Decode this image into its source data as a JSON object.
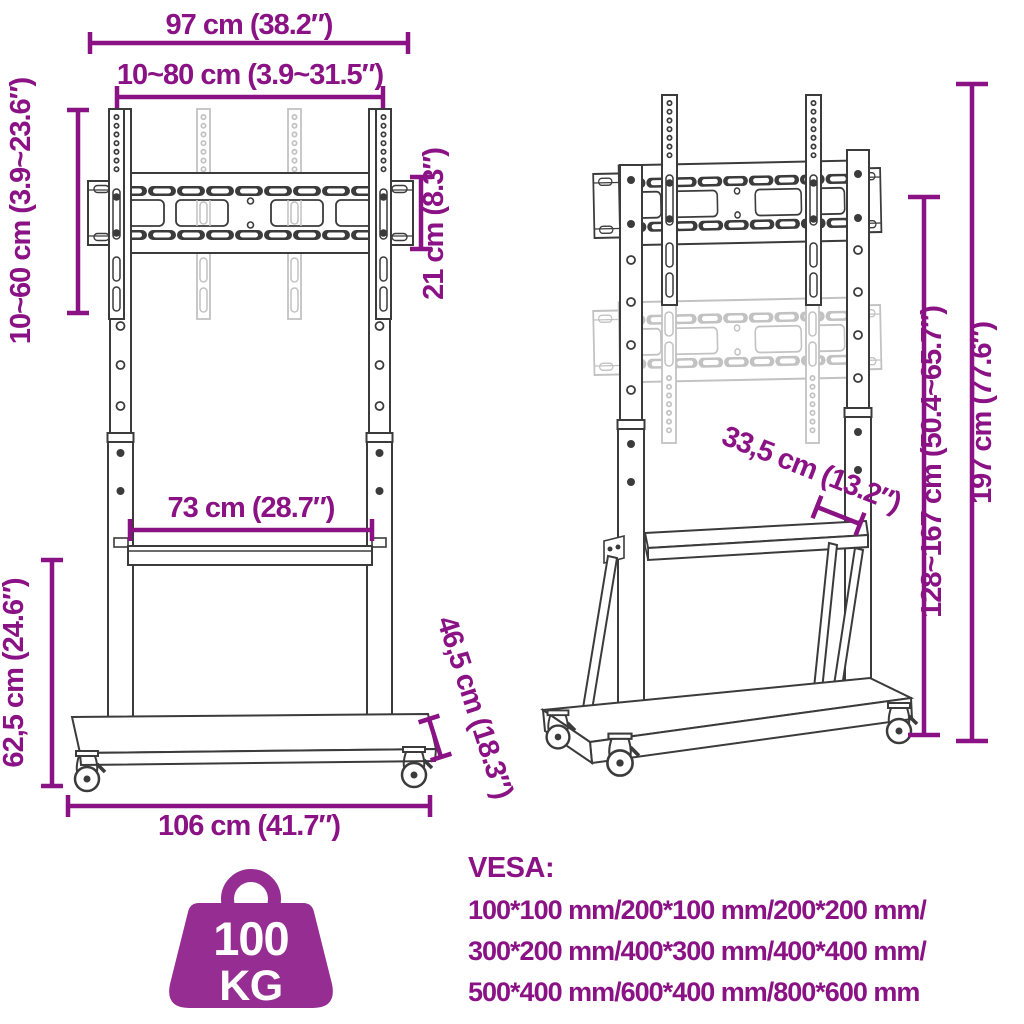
{
  "theme": {
    "accent": "#8A1285",
    "icon_purple": "#952D92",
    "ink": "#3b3b3b",
    "ghost": "#c2c2c2",
    "background": "#ffffff"
  },
  "dimensions": {
    "top_width": "97 cm (38.2″)",
    "vesa_width_range": "10~80 cm (3.9~31.5″)",
    "vesa_height_range": "10~60 cm (3.9~23.6″)",
    "bracket_height": "21 cm (8.3″)",
    "shelf_width": "73 cm (28.7″)",
    "lower_section_height": "62,5 cm (24.6″)",
    "base_width": "106 cm (41.7″)",
    "base_depth": "46,5 cm (18.3″)",
    "shelf_depth": "33,5 cm (13.2″)",
    "column_height_range": "128~167 cm (50.4~65.7″)",
    "total_height": "197 cm (77.6″)"
  },
  "weight_capacity": {
    "value": "100",
    "unit": "KG"
  },
  "vesa_compatibility": {
    "heading": "VESA:",
    "lines": [
      "100*100 mm/200*100 mm/200*200 mm/",
      "300*200 mm/400*300 mm/400*400 mm/",
      "500*400 mm/600*400 mm/800*600 mm"
    ]
  }
}
